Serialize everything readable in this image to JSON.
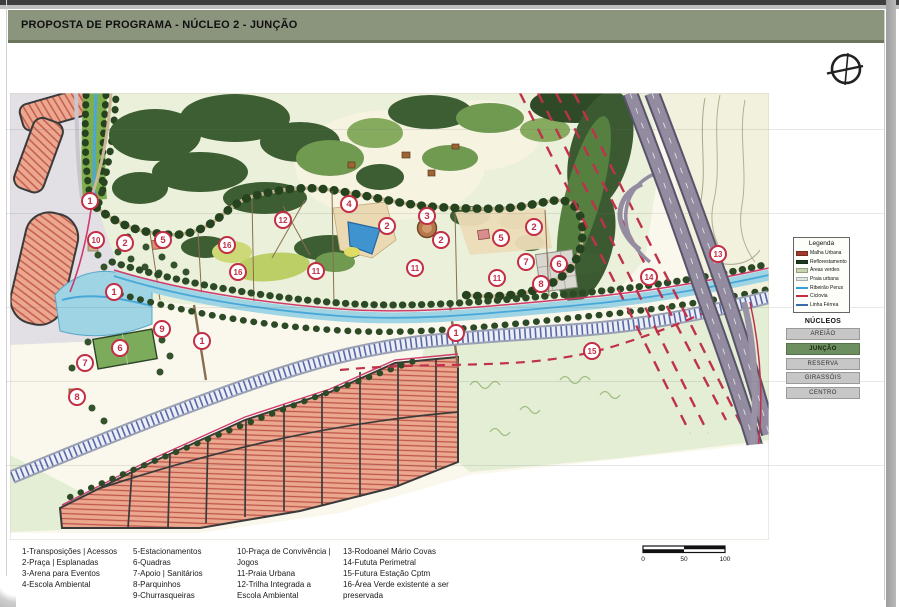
{
  "title_bar": {
    "text": "PROPOSTA DE PROGRAMA - NÚCLEO 2 - JUNÇÃO"
  },
  "legend": {
    "title": "Legenda",
    "items": [
      {
        "label": "Malha Urbana",
        "color": "#a03a2d",
        "swatch": "fill"
      },
      {
        "label": "Reflorestamento",
        "color": "#1e3d1f",
        "swatch": "fill"
      },
      {
        "label": "Áreas verdes",
        "color": "#c7d4ae",
        "swatch": "fill"
      },
      {
        "label": "Praia urbana",
        "color": "#dfe9e3",
        "swatch": "fill"
      },
      {
        "label": "Ribeirão Perus",
        "color": "#2f9fe0",
        "swatch": "line"
      },
      {
        "label": "Ciclovia",
        "color": "#c32e44",
        "swatch": "line"
      },
      {
        "label": "Linha Férrea",
        "color": "#3a6ea8",
        "swatch": "line"
      }
    ]
  },
  "nucleos": {
    "title": "NÚCLEOS",
    "active_color": "#6d8f60",
    "items": [
      {
        "label": "AREIÃO",
        "active": false
      },
      {
        "label": "JUNÇÃO",
        "active": true
      },
      {
        "label": "RESERVA",
        "active": false
      },
      {
        "label": "GIRASSÓIS",
        "active": false
      },
      {
        "label": "CENTRO",
        "active": false
      }
    ]
  },
  "program_list": {
    "columns": [
      [
        "1-Transposições | Acessos",
        "2-Praça | Esplanadas",
        "3-Arena para Eventos",
        "4-Escola Ambiental"
      ],
      [
        "5-Estacionamentos",
        "6-Quadras",
        "7-Apoio | Sanitários",
        "8-Parquinhos",
        "9-Churrasqueiras"
      ],
      [
        "10-Praça de Convivência | Jogos",
        "11-Praia Urbana",
        "12-Trilha Integrada a Escola Ambiental"
      ],
      [
        "13-Rodoanel Mário Covas",
        "14-Fututa Perimetral",
        "15-Futura Estação Cptm",
        "16-Área Verde existente a ser preservada"
      ]
    ]
  },
  "scale_bar": {
    "labels": [
      "0",
      "50",
      "100"
    ]
  },
  "map": {
    "marker_color": "#c32e44",
    "markers": [
      {
        "n": "1",
        "x": 90,
        "y": 201
      },
      {
        "n": "10",
        "x": 96,
        "y": 240
      },
      {
        "n": "2",
        "x": 125,
        "y": 243
      },
      {
        "n": "5",
        "x": 163,
        "y": 240
      },
      {
        "n": "16",
        "x": 227,
        "y": 245
      },
      {
        "n": "16",
        "x": 238,
        "y": 272
      },
      {
        "n": "12",
        "x": 283,
        "y": 220
      },
      {
        "n": "11",
        "x": 316,
        "y": 271
      },
      {
        "n": "1",
        "x": 114,
        "y": 292
      },
      {
        "n": "9",
        "x": 162,
        "y": 329
      },
      {
        "n": "6",
        "x": 120,
        "y": 348
      },
      {
        "n": "7",
        "x": 85,
        "y": 363
      },
      {
        "n": "8",
        "x": 77,
        "y": 397
      },
      {
        "n": "1",
        "x": 202,
        "y": 341
      },
      {
        "n": "4",
        "x": 349,
        "y": 204
      },
      {
        "n": "2",
        "x": 387,
        "y": 226
      },
      {
        "n": "3",
        "x": 427,
        "y": 216
      },
      {
        "n": "2",
        "x": 441,
        "y": 240
      },
      {
        "n": "11",
        "x": 415,
        "y": 268
      },
      {
        "n": "5",
        "x": 501,
        "y": 238
      },
      {
        "n": "2",
        "x": 534,
        "y": 227
      },
      {
        "n": "7",
        "x": 526,
        "y": 262
      },
      {
        "n": "6",
        "x": 559,
        "y": 264
      },
      {
        "n": "8",
        "x": 541,
        "y": 284
      },
      {
        "n": "11",
        "x": 497,
        "y": 278
      },
      {
        "n": "1",
        "x": 456,
        "y": 333
      },
      {
        "n": "15",
        "x": 592,
        "y": 351
      },
      {
        "n": "14",
        "x": 649,
        "y": 277
      },
      {
        "n": "13",
        "x": 718,
        "y": 254
      }
    ]
  }
}
